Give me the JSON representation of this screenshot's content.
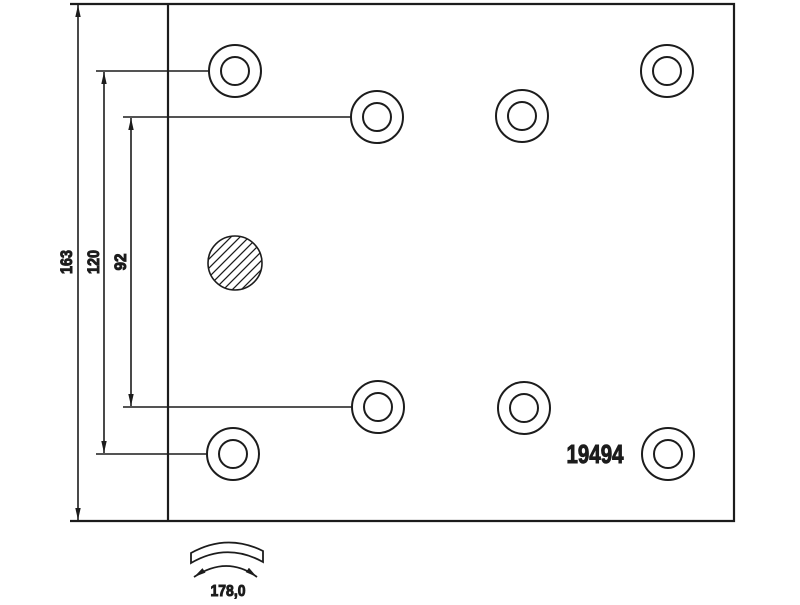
{
  "labels": {
    "dim_total_height": "163",
    "dim_outer_hole_span": "120",
    "dim_inner_hole_span": "92",
    "part_number": "19494",
    "arc_width": "178,0"
  },
  "colors": {
    "line": "#1c1c1c",
    "background": "#ffffff"
  },
  "geometry": {
    "plate": {
      "left": 168,
      "top": 4,
      "right": 734,
      "bottom": 521
    },
    "hole_outer_r": 26,
    "hole_inner_r": 14,
    "holes": [
      {
        "cx": 235,
        "cy": 71
      },
      {
        "cx": 377,
        "cy": 117
      },
      {
        "cx": 522,
        "cy": 116
      },
      {
        "cx": 667,
        "cy": 71
      },
      {
        "cx": 233,
        "cy": 454
      },
      {
        "cx": 378,
        "cy": 407
      },
      {
        "cx": 524,
        "cy": 408
      },
      {
        "cx": 668,
        "cy": 454
      }
    ],
    "hatched_hole": {
      "cx": 235,
      "cy": 263,
      "r": 27
    }
  }
}
